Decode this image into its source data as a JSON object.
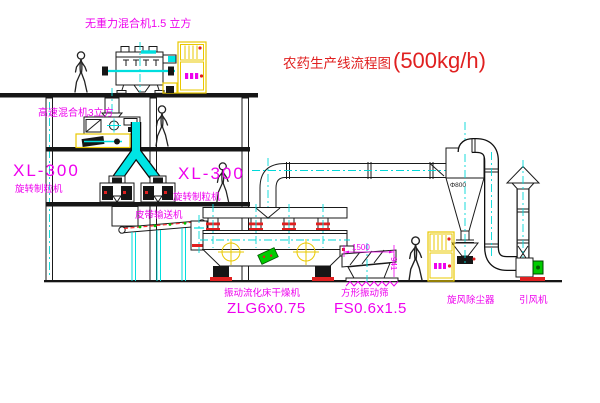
{
  "title": {
    "text": "农药生产线流程图",
    "capacity": "(500kg/h)"
  },
  "labels": {
    "gravity_mixer": "无重力混合机1.5 立方",
    "high_speed_mixer": "高速混合机3立方",
    "granulator_left": {
      "model": "XL-300",
      "name": "旋转制粒机"
    },
    "granulator_right": {
      "model": "XL-300",
      "name": "旋转制粒机"
    },
    "belt_conveyor": "皮带输送机",
    "fluid_bed_dryer": {
      "name": "振动流化床干燥机",
      "model": "ZLG6x0.75"
    },
    "vibrating_screen": {
      "name": "方形振动筛",
      "model": "FS0.6x1.5"
    },
    "cyclone": "旋风除尘器",
    "induced_draft_fan": "引风机"
  },
  "annotations": {
    "cyclone_diameter": "Φ800",
    "screen_length_dim": "1500",
    "screen_height_dim": "941"
  },
  "colors": {
    "label_magenta": "#ee00ee",
    "title_red": "#e02020",
    "line_black": "#1a1a1a",
    "centerline_cyan": "#00d8d8",
    "pipe_cyan": "#00e5e5",
    "cabinet_yellow": "#e9c800",
    "flange_red": "#e02020",
    "machine_green": "#00cc00"
  }
}
